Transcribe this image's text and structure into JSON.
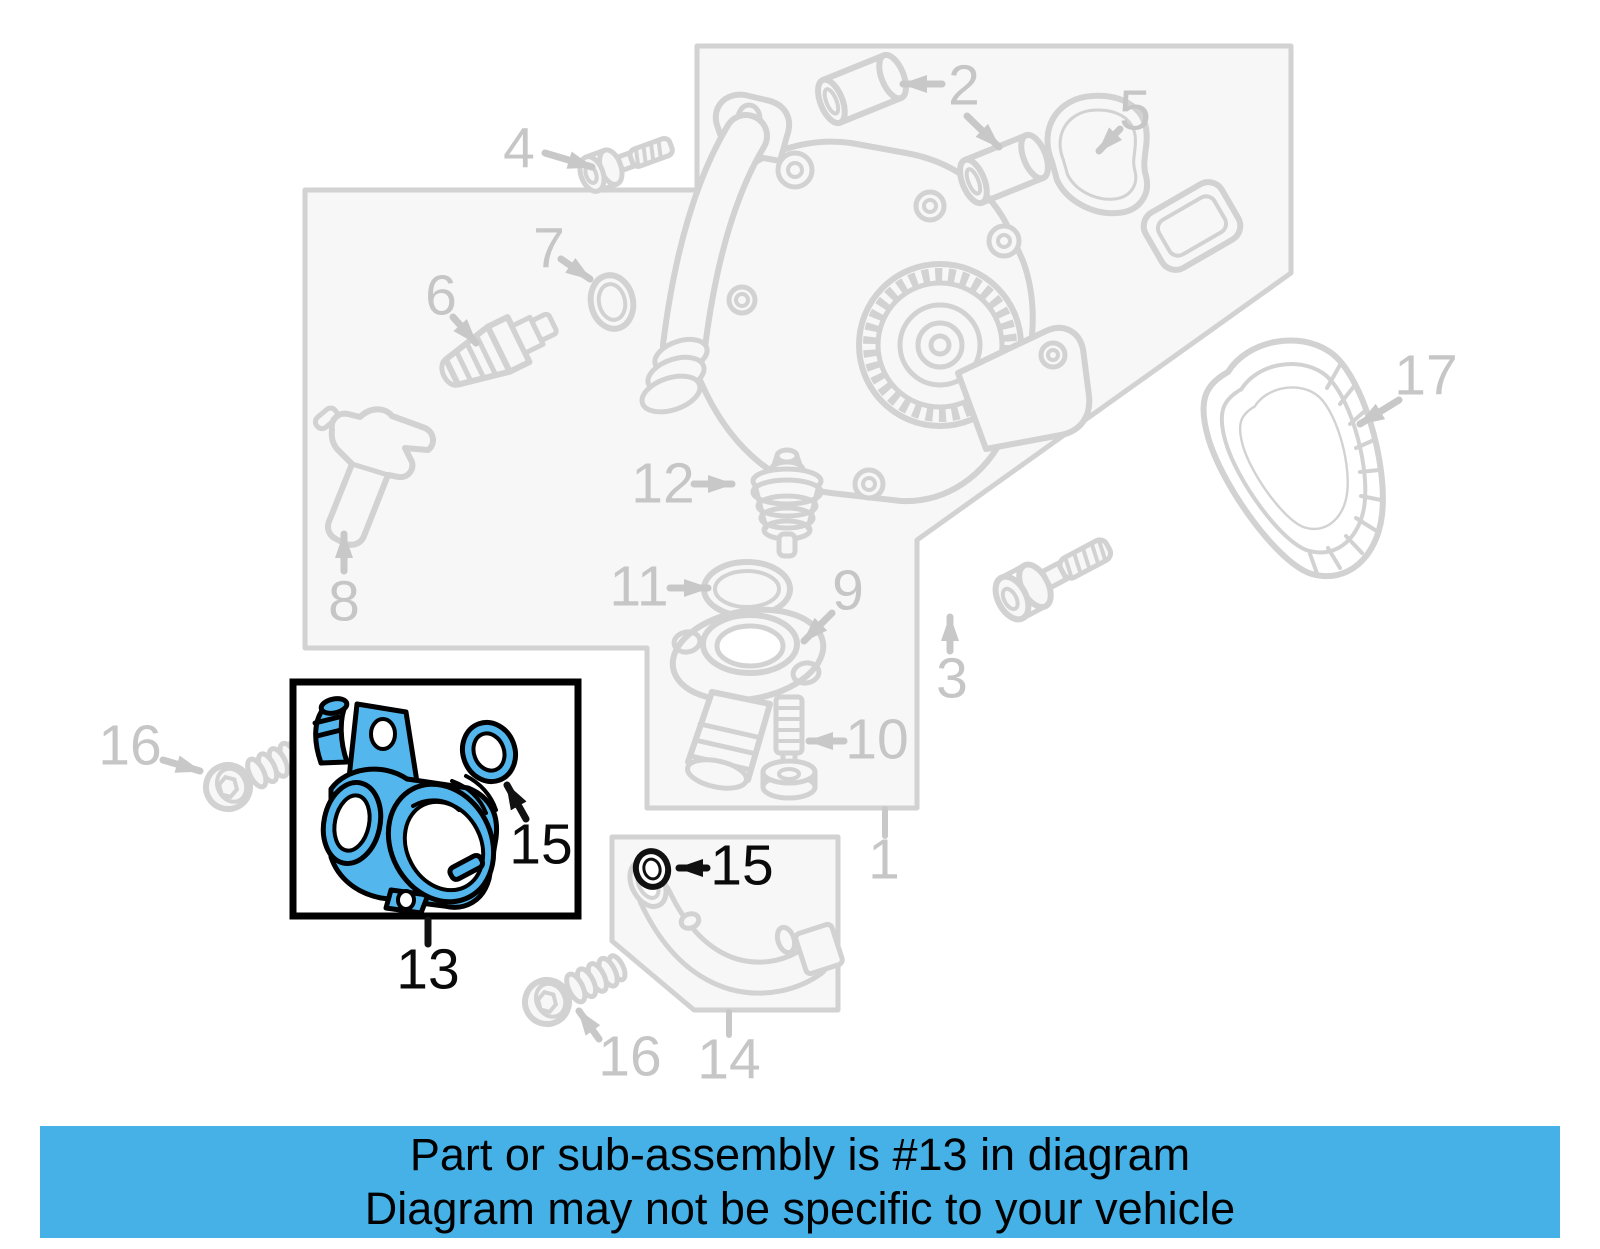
{
  "colors": {
    "highlight": "#53b7ed",
    "banner_bg": "#45b1e7",
    "line_art": "#d2d2d2",
    "callout_gray": "#c6c6c6",
    "callout_black": "#0a0a0a"
  },
  "diagram": {
    "highlighted_part_number": "13",
    "labels": [
      {
        "id": "callout-4",
        "text": "4",
        "x": 519,
        "y": 149,
        "color": "gray"
      },
      {
        "id": "callout-2",
        "text": "2",
        "x": 964,
        "y": 86,
        "color": "gray"
      },
      {
        "id": "callout-5",
        "text": "5",
        "x": 1135,
        "y": 111,
        "color": "gray"
      },
      {
        "id": "callout-7",
        "text": "7",
        "x": 549,
        "y": 249,
        "color": "gray"
      },
      {
        "id": "callout-6",
        "text": "6",
        "x": 441,
        "y": 296,
        "color": "gray"
      },
      {
        "id": "callout-17",
        "text": "17",
        "x": 1426,
        "y": 376,
        "color": "gray"
      },
      {
        "id": "callout-12",
        "text": "12",
        "x": 663,
        "y": 484,
        "color": "gray"
      },
      {
        "id": "callout-11",
        "text": "11",
        "x": 639,
        "y": 587,
        "color": "gray"
      },
      {
        "id": "callout-9",
        "text": "9",
        "x": 848,
        "y": 591,
        "color": "gray"
      },
      {
        "id": "callout-8",
        "text": "8",
        "x": 344,
        "y": 602,
        "color": "gray"
      },
      {
        "id": "callout-3",
        "text": "3",
        "x": 952,
        "y": 679,
        "color": "gray"
      },
      {
        "id": "callout-10",
        "text": "10",
        "x": 877,
        "y": 740,
        "color": "gray"
      },
      {
        "id": "callout-16-left",
        "text": "16",
        "x": 130,
        "y": 746,
        "color": "gray"
      },
      {
        "id": "callout-1",
        "text": "1",
        "x": 884,
        "y": 860,
        "color": "gray"
      },
      {
        "id": "callout-15-inset",
        "text": "15",
        "x": 541,
        "y": 845,
        "color": "black"
      },
      {
        "id": "callout-15-pipe",
        "text": "15",
        "x": 742,
        "y": 866,
        "color": "black"
      },
      {
        "id": "callout-13",
        "text": "13",
        "x": 428,
        "y": 970,
        "color": "black"
      },
      {
        "id": "callout-14",
        "text": "14",
        "x": 729,
        "y": 1060,
        "color": "gray"
      },
      {
        "id": "callout-16-bottom",
        "text": "16",
        "x": 630,
        "y": 1057,
        "color": "gray"
      }
    ]
  },
  "banner": {
    "line1": "Part or sub-assembly is #13 in diagram",
    "line2": "Diagram may not be specific to your vehicle"
  }
}
